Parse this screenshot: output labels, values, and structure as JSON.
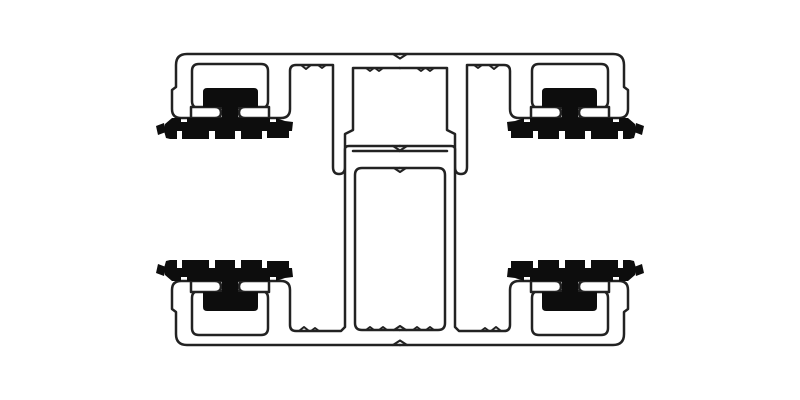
{
  "diagram": {
    "name": "aluminum-extrusion-profile-cross-section",
    "canvas": {
      "width": 800,
      "height": 400,
      "background": "#ffffff"
    },
    "style": {
      "outline_color": "#222222",
      "metal_fill": "#ffffff",
      "gasket_color": "#0d0d0d",
      "outline_width": 2.5,
      "tick_width": 2,
      "center_mark_width": 2.2
    },
    "symmetry": {
      "horizontal_mirror": "translate(800,0) scale(-1,1)",
      "vertical_mirror": "translate(0,399) scale(1,-1)"
    },
    "shared_groups": {
      "pocket-unit": [
        {
          "name": "gasket-channel",
          "d": "M199,64 H261 Q268,64 268,71 V101 Q268,108 261,108 H199 Q192,108 192,101 V71 Q192,64 199,64 Z",
          "fill": "metal",
          "stroke": "outline",
          "width": "outline"
        },
        {
          "name": "channel-lip-left",
          "d": "M191,107 H215 Q221,107 221,112.5 Q221,118 215,118 H191 Z",
          "fill": "metal",
          "stroke": "outline",
          "width": "outline"
        },
        {
          "name": "channel-lip-right",
          "d": "M269,107 H245 Q239,107 239,112.5 Q239,118 245,118 H269 Z",
          "fill": "metal",
          "stroke": "outline",
          "width": "outline"
        }
      ],
      "gasket-unit": [
        {
          "name": "gasket-body",
          "d": "M203,107 V92 Q203,88 207,88 H254 Q258,88 258,92 V107 L238,107 V118 H270 V122 H276 V118 L285,121 L293,122 L292,131 L289,131 L289,138 H267 V131 H262 V139 H241 V131 H235 V139 H215 V131 H209 V139 H182 V131 H177 V139 H170 L166,138 L164,131 L165,124 L172,118 H181 V122 H187 V118 H222 V107 Z",
          "fill": "gasket",
          "stroke": "none",
          "width": "outline"
        },
        {
          "name": "gasket-debris",
          "d": "M156,126 L164,123 L166,132 L158,135 Z",
          "fill": "gasket",
          "stroke": "none",
          "width": "outline"
        }
      ]
    },
    "half_items": [
      {
        "kind": "path",
        "name": "top-cap-profile",
        "d": "M400,54 H187 Q176,54 176,65 V87 L172,90 V109 Q172,118 181,118 H281 Q290,118 290,109 V71 Q290,65 296,65 H333 V167 Q333,174 339,174 Q345,174 345,167 V134 L353,130 V68 H400",
        "fill": "metal",
        "stroke": "outline",
        "width": "outline"
      },
      {
        "kind": "path",
        "name": "bottom-base-profile",
        "d": "M400,345 H187 Q176,345 176,334 V312 L172,309 V290 Q172,281 181,281 H281 Q290,281 290,290 V325 Q290,331 296,331 H341 L345,327 V149 Q345,146 349,146 H400",
        "fill": "metal",
        "stroke": "outline",
        "width": "outline"
      },
      {
        "kind": "use",
        "name": "gasket-pocket-top",
        "ref": "pocket-unit",
        "transform": ""
      },
      {
        "kind": "use",
        "name": "gasket-pocket-bottom",
        "ref": "pocket-unit",
        "transform": "vertical_mirror"
      },
      {
        "kind": "path",
        "name": "column-ledge-inner-line",
        "d": "M353,151 H400",
        "fill": "none",
        "stroke": "outline",
        "width": "outline"
      },
      {
        "kind": "path",
        "name": "screw-box",
        "d": "M400,168 H362 Q355,168 355,175 V323 Q355,330 362,330 H400",
        "fill": "none",
        "stroke": "outline",
        "width": "outline"
      },
      {
        "kind": "path",
        "name": "extrusion-id-ticks",
        "d": "M301,65 l5,4 l5,-4 M318,65 l4,3 l4,-3 M366,68 l4,3 l4,-3 M375,68 l4,3 l4,-3 M299,331 l5,-4 l5,4 M311,331 l4,-3 l4,3 M366,330 l4,-3 l4,3 M379,330 l4,-3 l4,3",
        "fill": "none",
        "stroke": "outline",
        "width": "tick"
      },
      {
        "kind": "use",
        "name": "gasket-top-left",
        "ref": "gasket-unit",
        "transform": ""
      },
      {
        "kind": "use",
        "name": "gasket-bottom-left",
        "ref": "gasket-unit",
        "transform": "vertical_mirror"
      }
    ],
    "center_marks": {
      "name": "center-notch-marks",
      "d": "M393,54 L400,58.5 L407,54 M393,146 L400,150.5 L407,146 M394,168 L400,172 L406,168 M394,330 L400,326 L406,330 M393,345 L400,340.5 L407,345",
      "fill": "none",
      "stroke": "outline",
      "width": "center_mark"
    }
  }
}
